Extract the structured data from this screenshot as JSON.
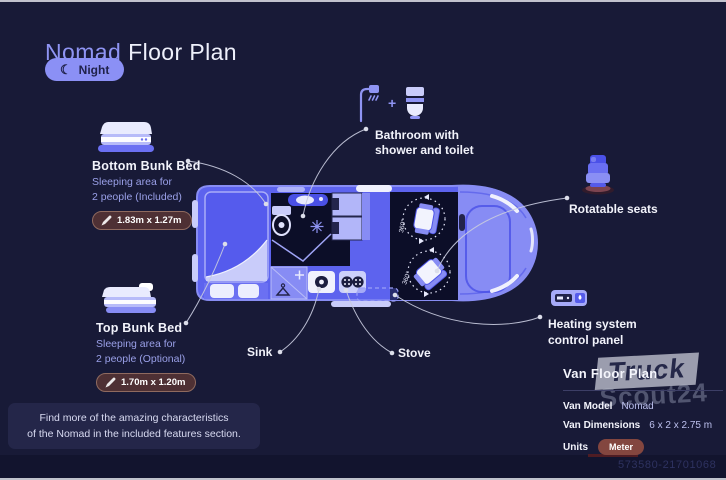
{
  "header": {
    "title_accent": "Nomad",
    "title_rest": "Floor Plan",
    "mode_label": "Night"
  },
  "callouts": {
    "bottom_bunk": {
      "title": "Bottom Bunk Bed",
      "desc_line1": "Sleeping area for",
      "desc_line2": "2 people (Included)",
      "dimensions": "1.83m x 1.27m"
    },
    "top_bunk": {
      "title": "Top Bunk Bed",
      "desc_line1": "Sleeping area for",
      "desc_line2": "2 people (Optional)",
      "dimensions": "1.70m x 1.20m"
    },
    "bathroom": {
      "plus": "+",
      "line1": "Bathroom with",
      "line2": "shower and toilet"
    },
    "rotatable_seats": {
      "label": "Rotatable seats"
    },
    "heating": {
      "line1": "Heating system",
      "line2": "control panel"
    },
    "sink": {
      "label": "Sink"
    },
    "stove": {
      "label": "Stove"
    }
  },
  "floorplan": {
    "rotation_label": "360°"
  },
  "info_panel": {
    "title": "Van Floor Plan",
    "rows": [
      {
        "label": "Van Model",
        "value": "Nomad"
      },
      {
        "label": "Van Dimensions",
        "value": "6 x 2 x 2.75 m"
      },
      {
        "label": "Units",
        "value": "Meter"
      }
    ]
  },
  "note": {
    "line1": "Find more of the amazing characteristics",
    "line2": "of the Nomad in the included features section."
  },
  "watermark": {
    "top": "Truck",
    "bottom": "Scout24"
  },
  "listing_id": "573580-21701068",
  "colors": {
    "background": "#181a37",
    "accent": "#8b90f5",
    "van_body": "#5d63ee",
    "dark_room": "#0c0e28",
    "badge_bg": "#4e3034",
    "units_badge_bg": "#83463f"
  }
}
